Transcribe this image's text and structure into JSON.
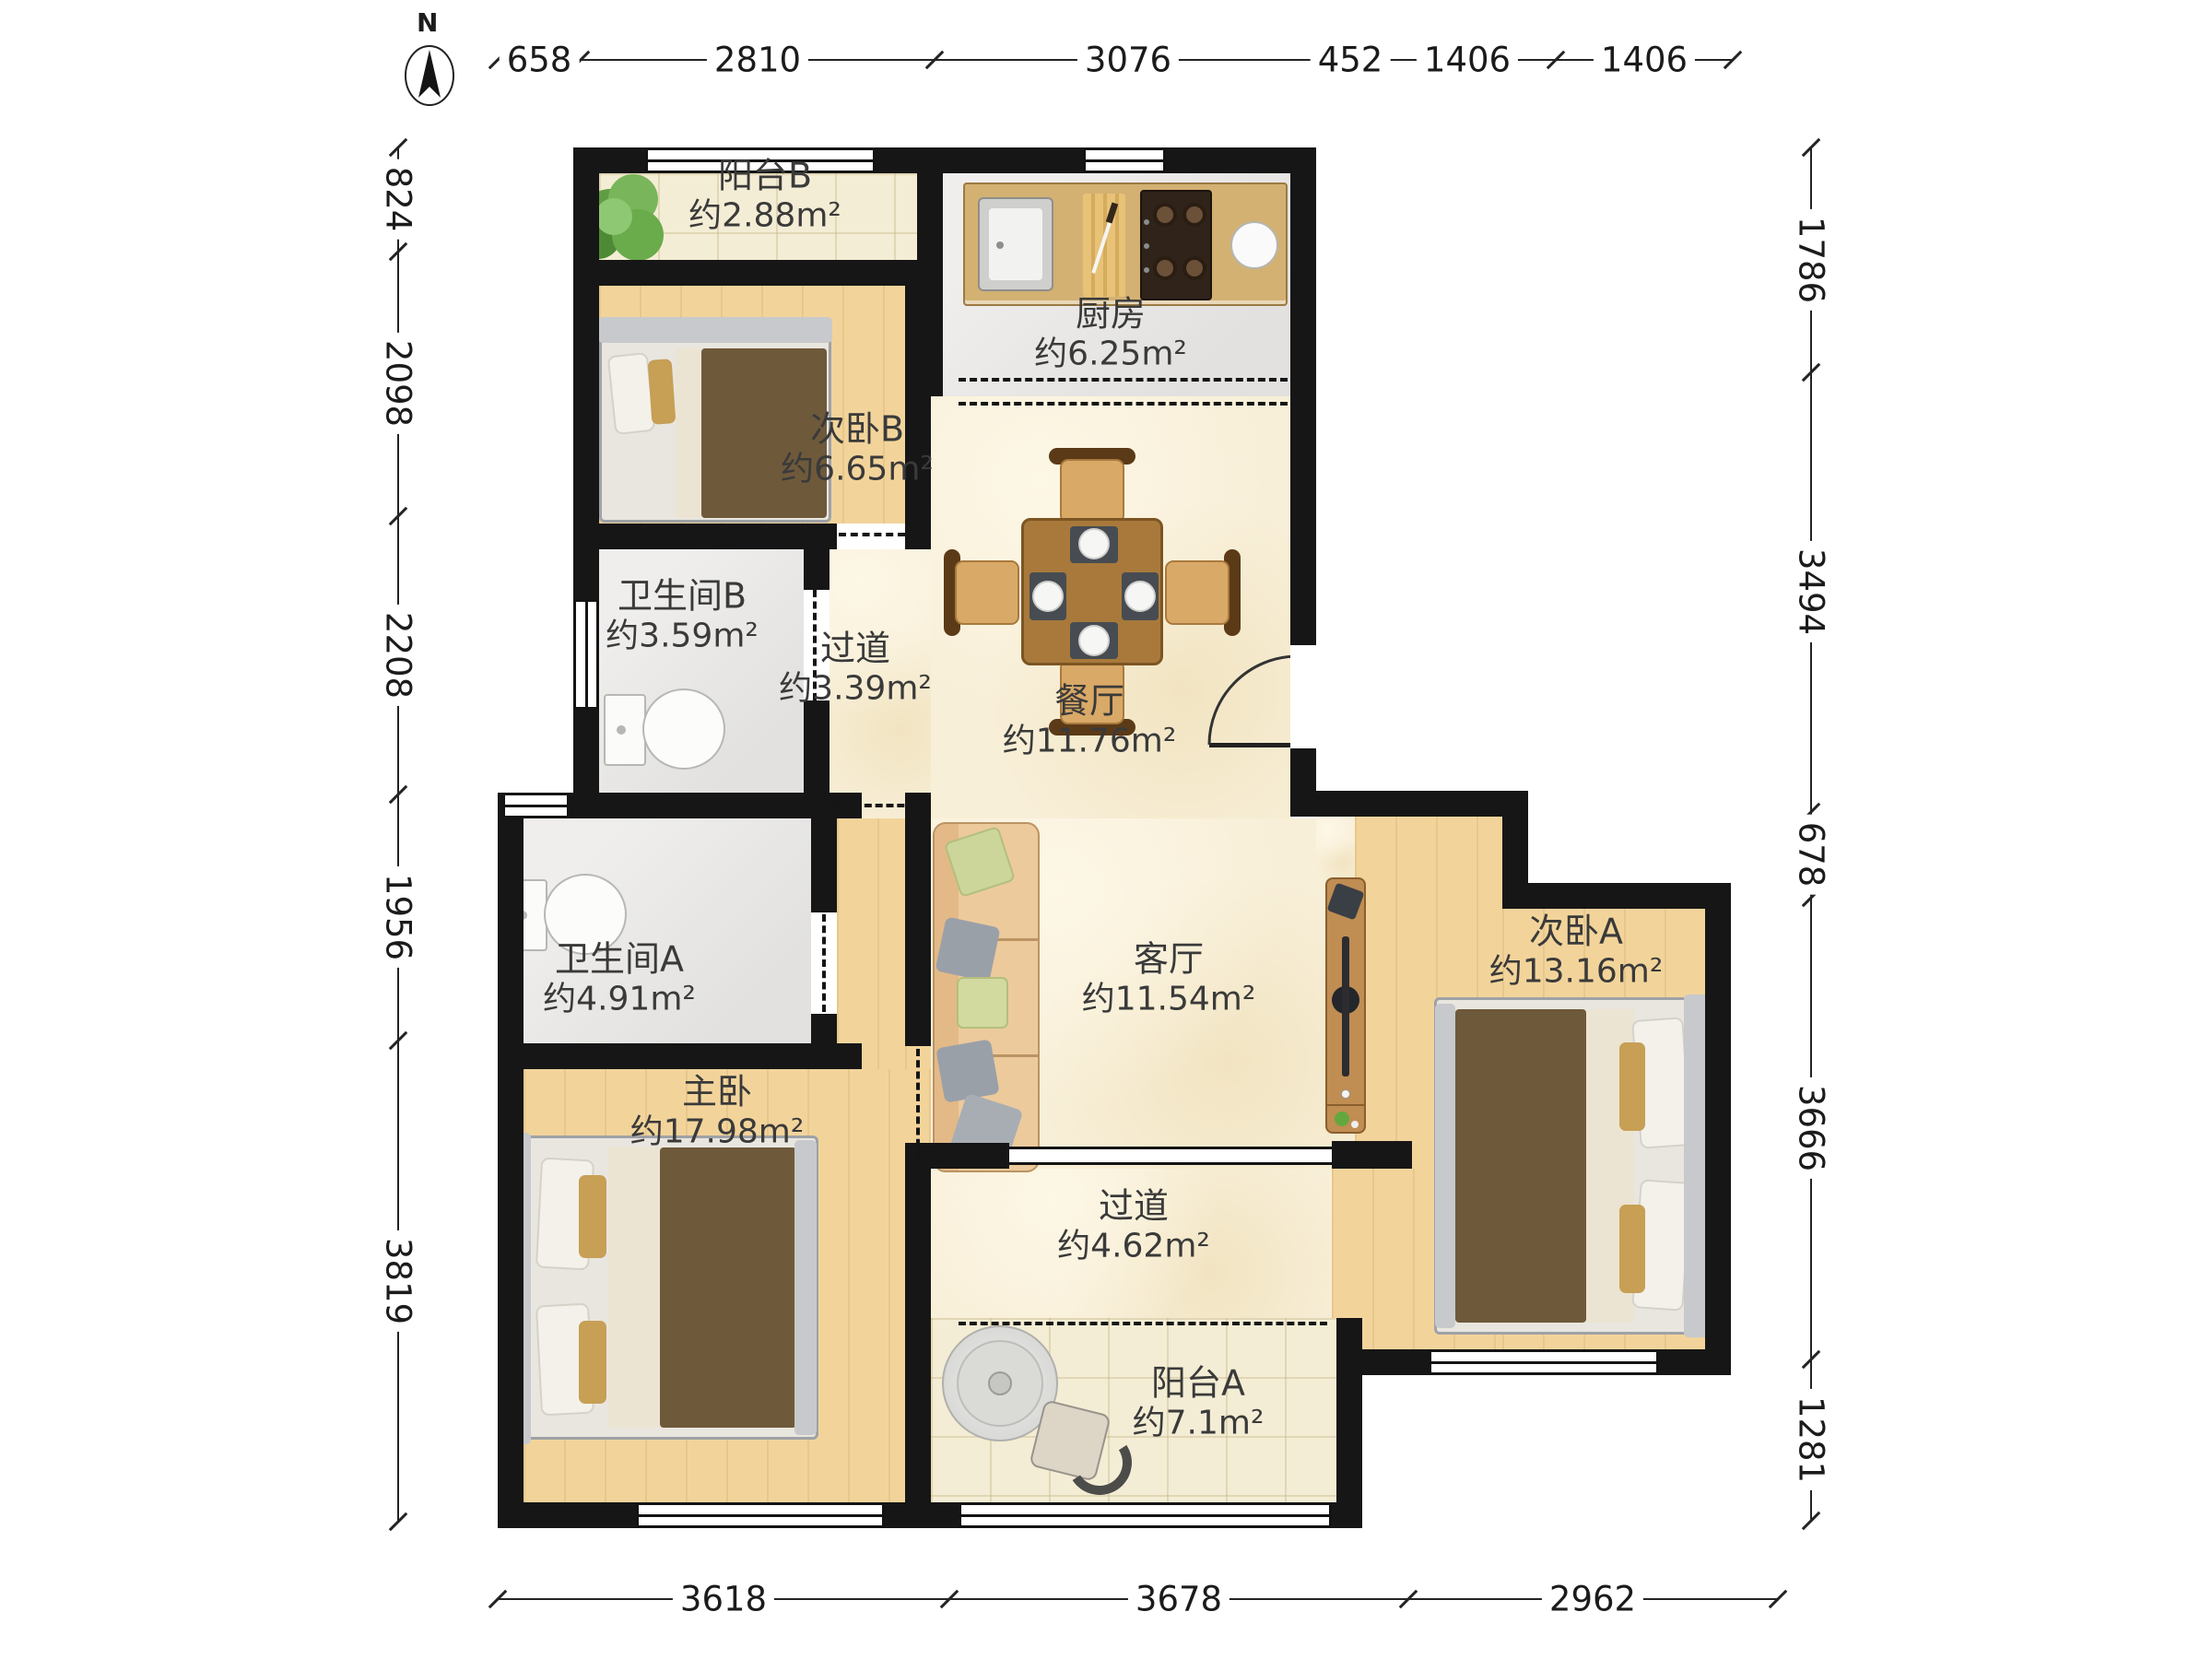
{
  "compass": {
    "label": "N"
  },
  "dimensions": {
    "top": [
      "658",
      "2810",
      "3076",
      "452",
      "1406",
      "1406"
    ],
    "left": [
      "824",
      "2098",
      "2208",
      "1956",
      "3819"
    ],
    "right": [
      "1786",
      "3494",
      "678",
      "3666",
      "1281"
    ],
    "bottom": [
      "3618",
      "3678",
      "2962"
    ]
  },
  "rooms": [
    {
      "id": "balcony-b",
      "name": "阳台B",
      "area": "约2.88m²"
    },
    {
      "id": "kitchen",
      "name": "厨房",
      "area": "约6.25m²"
    },
    {
      "id": "bedroom-b",
      "name": "次卧B",
      "area": "约6.65m²"
    },
    {
      "id": "bathroom-b",
      "name": "卫生间B",
      "area": "约3.59m²"
    },
    {
      "id": "hallway-b",
      "name": "过道",
      "area": "约3.39m²"
    },
    {
      "id": "dining-room",
      "name": "餐厅",
      "area": "约11.76m²"
    },
    {
      "id": "bathroom-a",
      "name": "卫生间A",
      "area": "约4.91m²"
    },
    {
      "id": "living-room",
      "name": "客厅",
      "area": "约11.54m²"
    },
    {
      "id": "bedroom-a",
      "name": "次卧A",
      "area": "约13.16m²"
    },
    {
      "id": "master-bedroom",
      "name": "主卧",
      "area": "约17.98m²"
    },
    {
      "id": "hallway-a",
      "name": "过道",
      "area": "约4.62m²"
    },
    {
      "id": "balcony-a",
      "name": "阳台A",
      "area": "约7.1m²"
    }
  ],
  "furniture_icons": [
    "plant-icon",
    "kitchen-counter",
    "sink-icon",
    "cutting-board-icon",
    "stove-icon",
    "bowl-icon",
    "single-bed-icon",
    "toilet-icon",
    "dining-table-icon",
    "chair-icon",
    "entry-door-icon",
    "sofa-icon",
    "tv-cabinet-icon",
    "double-bed-icon",
    "washer-icon",
    "balcony-chair-icon",
    "compass-icon"
  ],
  "colors": {
    "wall": "#161616",
    "wood_floor": "#f2d49b",
    "marble_floor": "#f8efd8",
    "tile_floor": "#f4edd5",
    "gray_floor": "#e7e6e4",
    "counter": "#d3b172",
    "table": "#a8793b",
    "blanket": "#6e593b",
    "sofa": "#ecca9c",
    "pillow_green": "#ccd69b",
    "pillow_gray": "#9aa0a8",
    "plant": "#5f9c43"
  }
}
